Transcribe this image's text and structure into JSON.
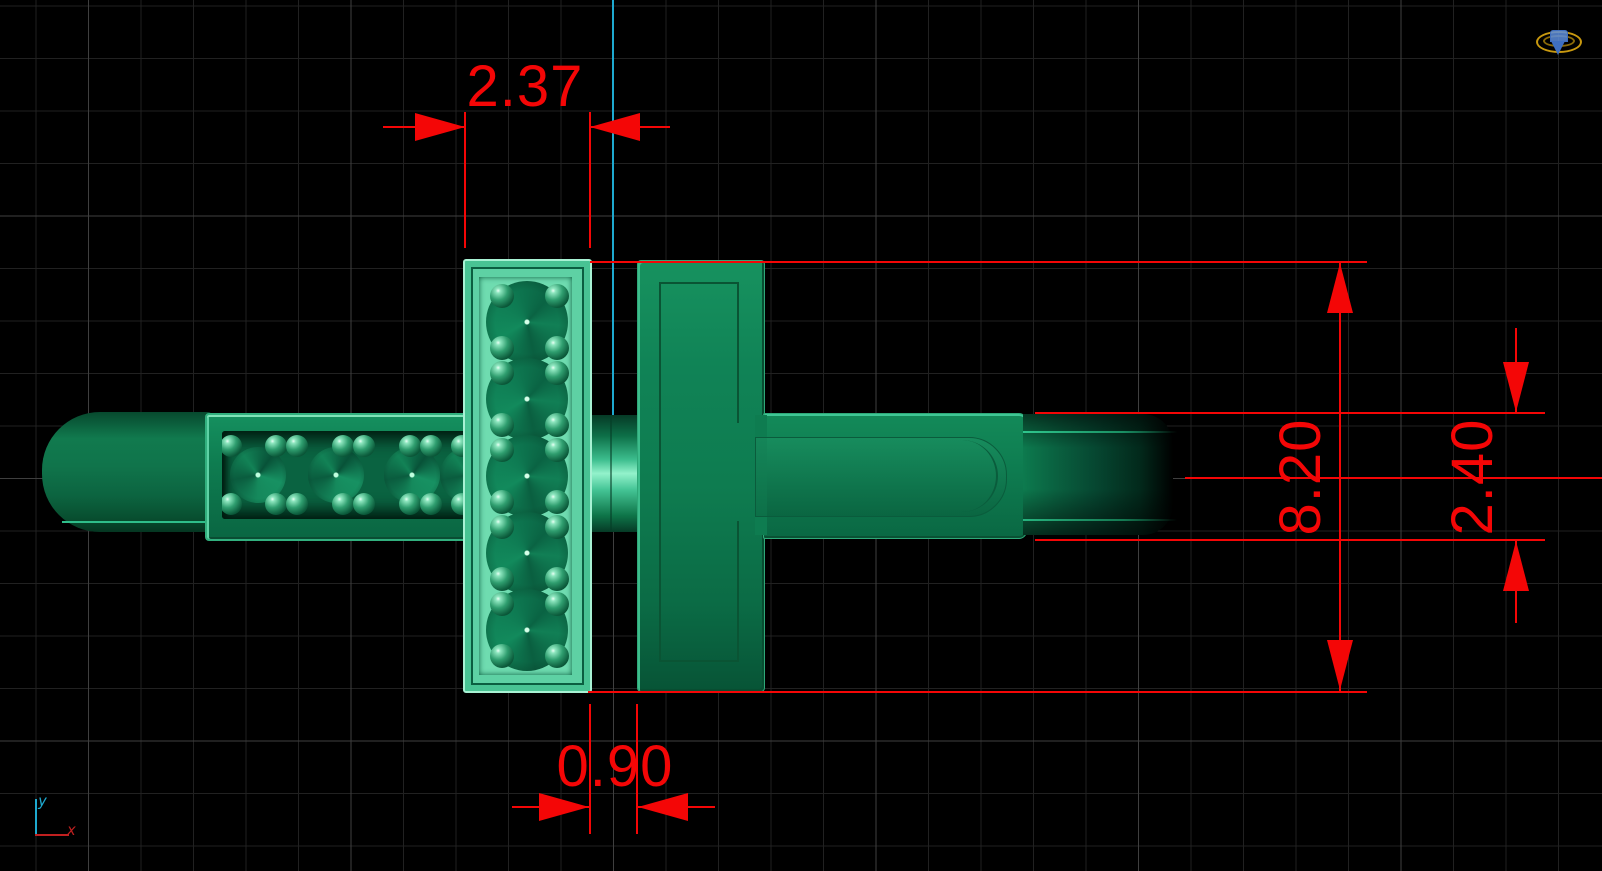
{
  "viewport": {
    "background_color": "#000000",
    "grid_minor_color": "#212121",
    "grid_major_color": "#3f3f3f",
    "grid_cell_mm": "1"
  },
  "model": {
    "description": "ring with cross-shaped pave gem settings, top view",
    "material_color": "#0e7c50",
    "highlight_color": "#93f2cb"
  },
  "annotation_color": "#f40606",
  "dimensions": {
    "setting_width": {
      "value": "2.37"
    },
    "center_gap": {
      "value": "0.90"
    },
    "setting_height": {
      "value": "8.20"
    },
    "band_width": {
      "value": "2.40"
    }
  },
  "axes": {
    "y_label": "y",
    "x_label": "x",
    "y_color": "#1ea9cf",
    "x_color": "#c02020"
  },
  "scene_icon": {
    "name": "ring-gem-icon",
    "ring_color": "#c9990f",
    "gem_color": "#3f6fc0"
  }
}
